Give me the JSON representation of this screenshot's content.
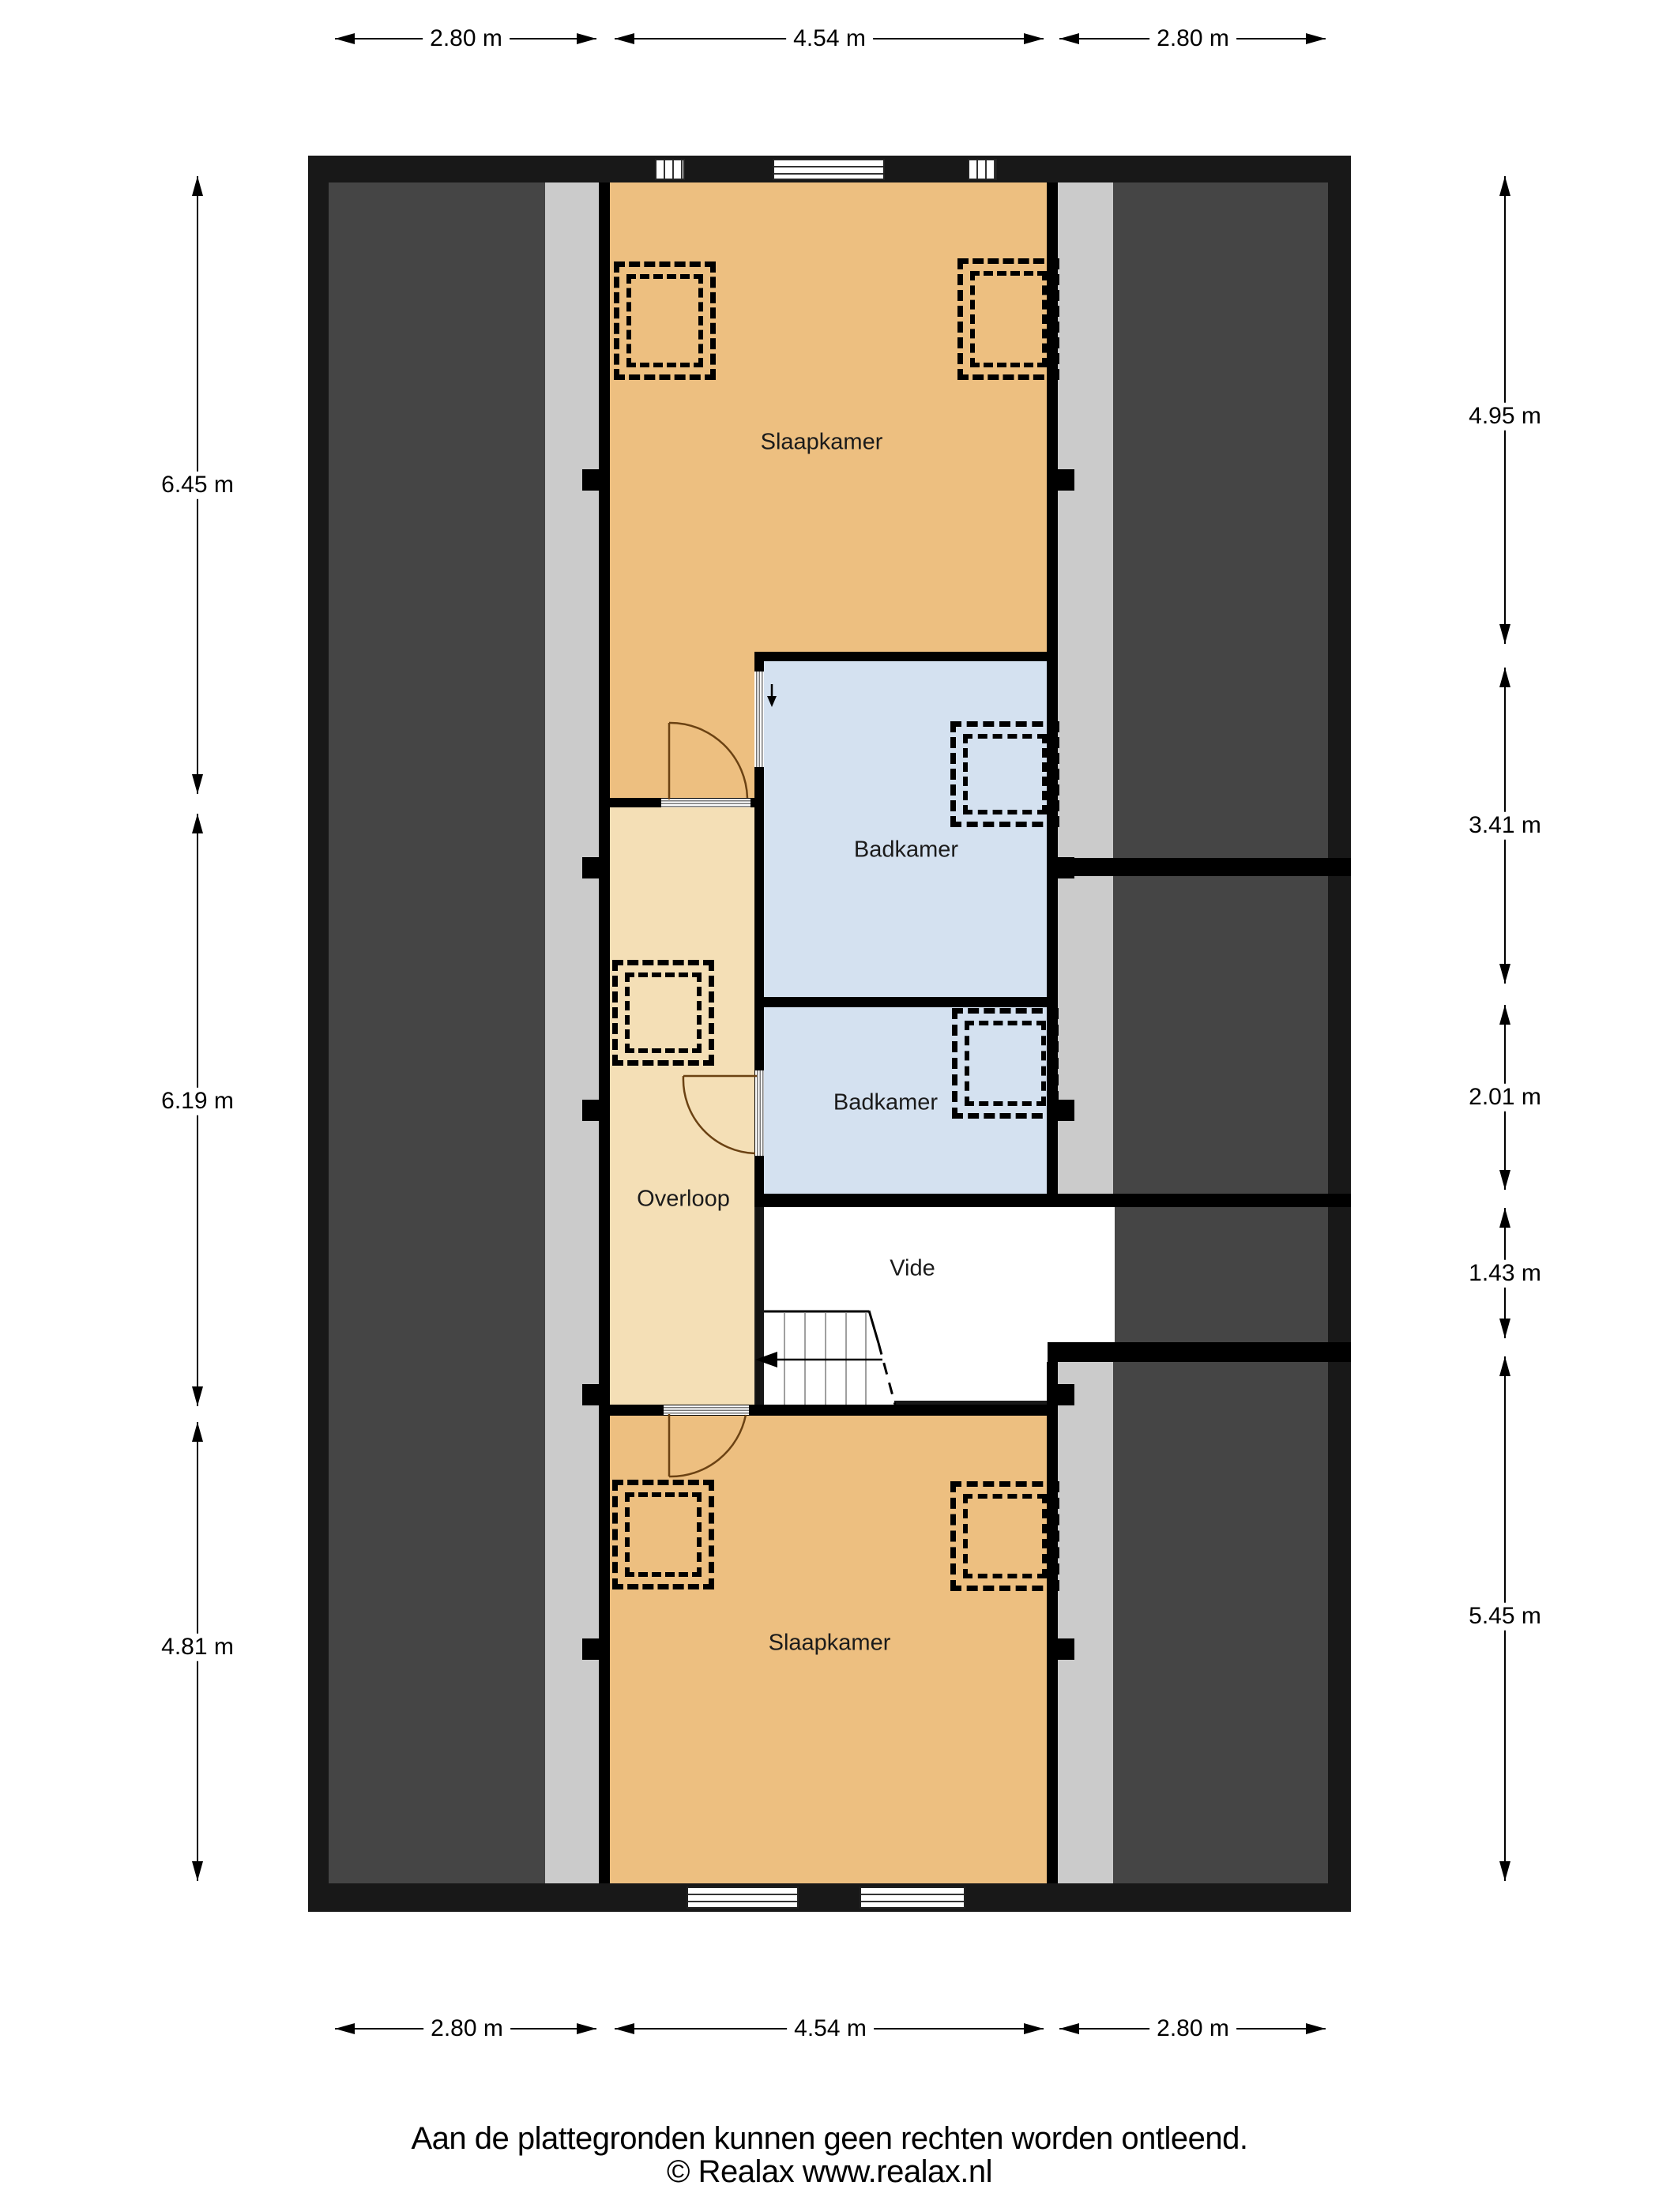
{
  "plan_type": "floor-plan (verdieping / attic floor)",
  "rooms": {
    "slaapkamer_top": "Slaapkamer",
    "badkamer_top": "Badkamer",
    "badkamer_bottom": "Badkamer",
    "overloop": "Overloop",
    "vide": "Vide",
    "slaapkamer_bottom": "Slaapkamer"
  },
  "dimensions": {
    "top": [
      "2.80 m",
      "4.54 m",
      "2.80 m"
    ],
    "bottom": [
      "2.80 m",
      "4.54 m",
      "2.80 m"
    ],
    "left": [
      "6.45 m",
      "6.19 m",
      "4.81 m"
    ],
    "right": [
      "4.95 m",
      "3.41 m",
      "2.01 m",
      "1.43 m",
      "5.45 m"
    ]
  },
  "footer": {
    "disclaimer": "Aan de plattegronden kunnen geen rechten worden ontleend.",
    "copyright": "© Realax www.realax.nl"
  },
  "colors": {
    "room_orange": "#edbf80",
    "hall_tan": "#f4dfb6",
    "bathroom_blue": "#d4e1f0",
    "attic_dark_gray": "#454545",
    "knee_strip_gray": "#cbcbcb",
    "wall_black": "#000000",
    "outer_ring": "#181818",
    "background": "#ffffff"
  }
}
